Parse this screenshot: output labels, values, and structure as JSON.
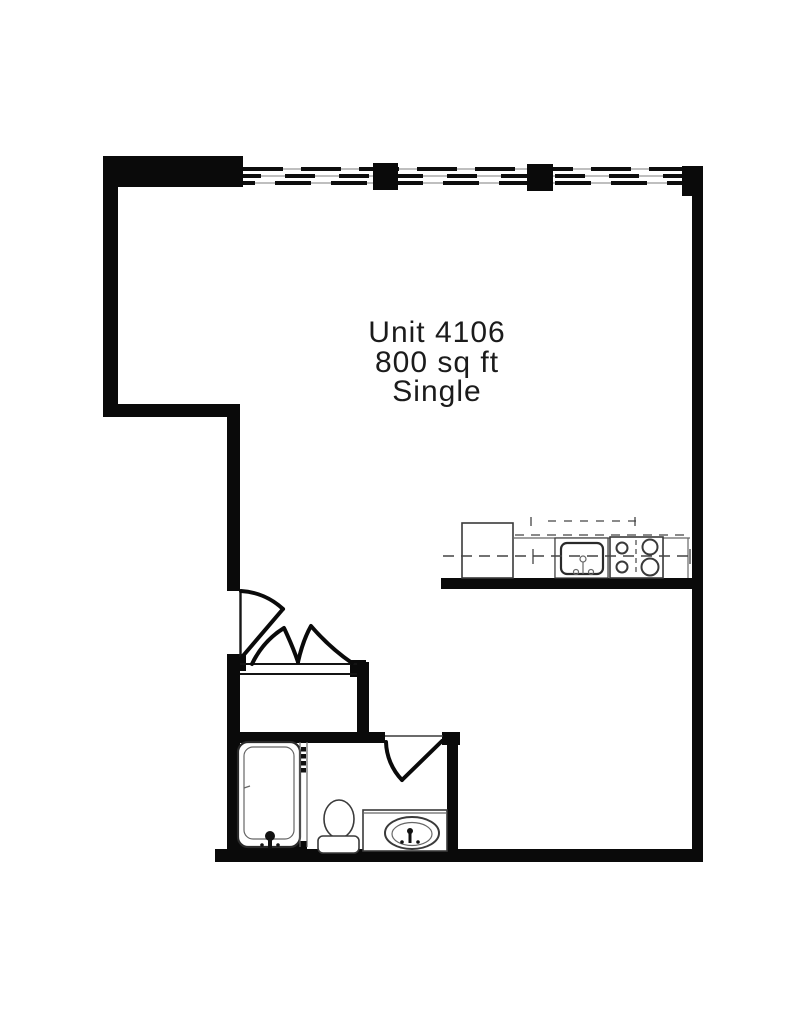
{
  "title": {
    "line1": "Unit 4106",
    "line2": "800 sq ft",
    "line3": "Single"
  },
  "colors": {
    "wall": "#0a0a0a",
    "fixture": "#3a3a3a",
    "dash": "#444444",
    "text": "#1b1b1b",
    "background": "#ffffff"
  },
  "fixtures": {
    "window_band": "window-band",
    "entry_door": "entry-door",
    "closet_doors": "bifold-closet-doors",
    "bathroom_door": "bathroom-door",
    "refrigerator": "refrigerator",
    "kitchen_sink": "kitchen-sink",
    "stove": "stove",
    "bathtub": "bathtub",
    "toilet": "toilet",
    "vanity_sink": "vanity-sink"
  }
}
